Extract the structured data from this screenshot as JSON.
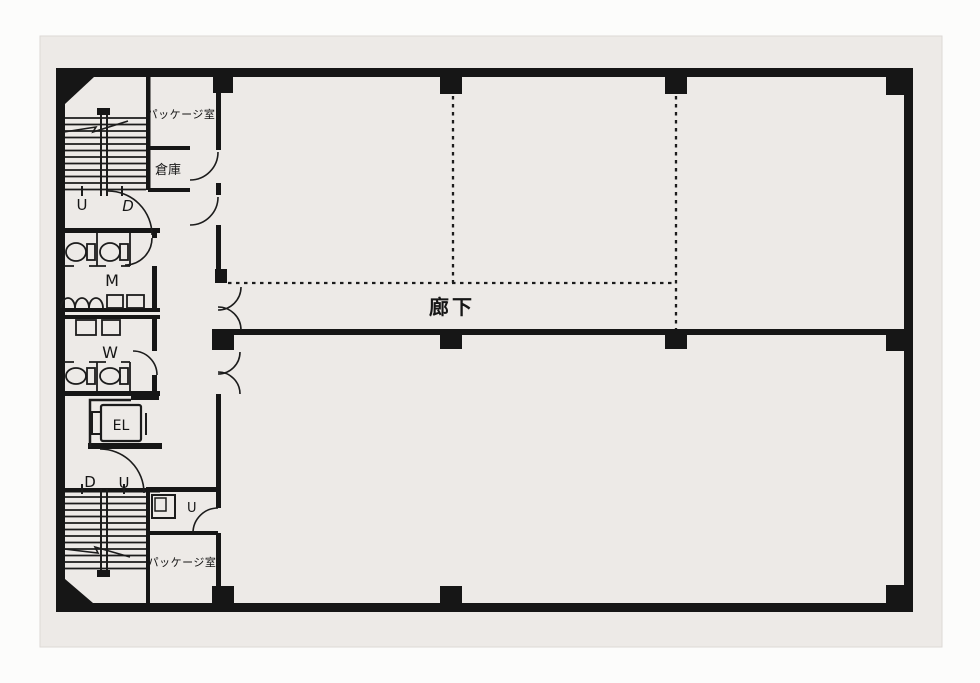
{
  "labels": {
    "corridor": "廊下",
    "package_room_top": "パッケージ室",
    "storage": "倉庫",
    "mens_restroom": "M",
    "womens_restroom": "W",
    "elevator": "EL",
    "stairs_top_up": "U",
    "stairs_top_down": "D",
    "stairs_bottom_down": "D",
    "stairs_bottom_up": "U",
    "duct": "U",
    "package_room_bottom": "パッケージ室"
  },
  "colors": {
    "ink": "#161616",
    "paper": "#edeae7",
    "page": "#fcfcfb"
  }
}
